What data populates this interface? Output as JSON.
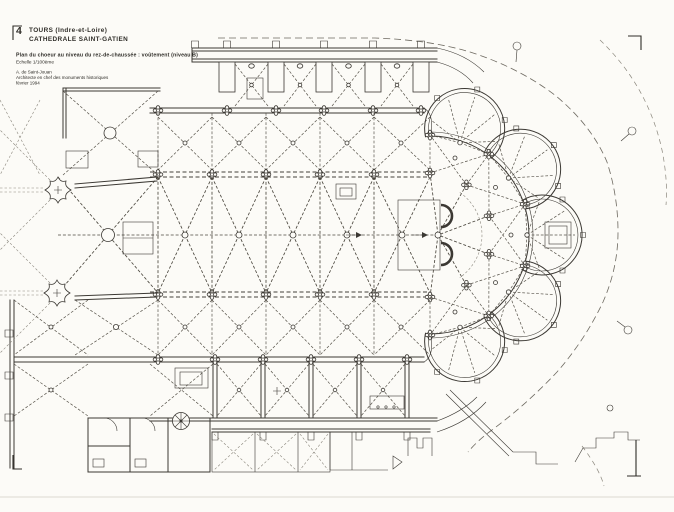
{
  "header": {
    "figure_number": "4",
    "location": "TOURS  (Indre-et-Loire)",
    "building": "CATHEDRALE  SAINT-GATIEN"
  },
  "caption": {
    "title": "Plan du choeur au niveau du rez-de-chaussée : voûtement (niveau B)",
    "scale": "Echelle 1/100ème"
  },
  "credits": {
    "architect": "A. de Saint-Jouan",
    "role": "Architecte en chef des monuments historiques",
    "date": "février 1994"
  },
  "drawing": {
    "kind": "architectural floor plan",
    "subject": "Chœur et chevet à chapelles rayonnantes, voûtes d'ogives",
    "ink_color": "#3b3833",
    "paper_color": "#fcfbf7"
  }
}
